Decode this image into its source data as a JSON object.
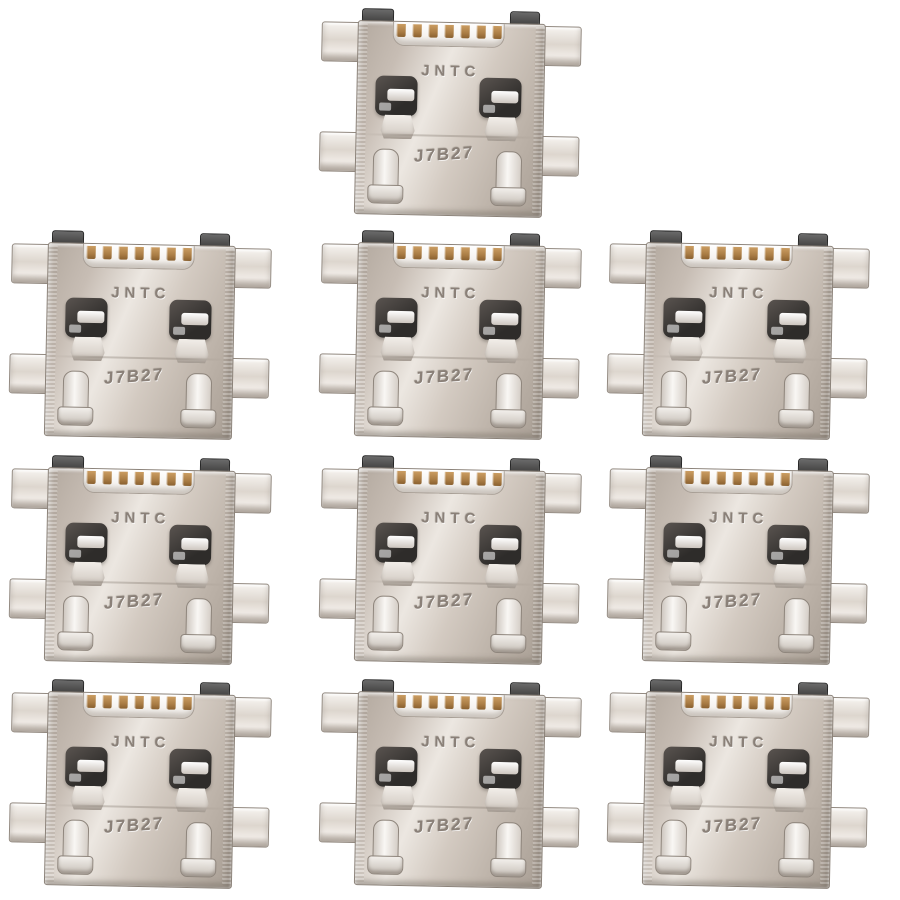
{
  "photo": {
    "background_color": "#ffffff",
    "item_count": 10
  },
  "connector": {
    "brand_marking": "JNTC",
    "code_marking": "J7B27",
    "pin_count": 7,
    "colors": {
      "bg": "#ffffff",
      "metal_base": "#c7bdb4",
      "metal_light": "#ece7e1",
      "metal_dark": "#a89e94",
      "metal_edge": "#8b8279",
      "latch": "#3e3c3a",
      "pin_gold": "#aa7d45",
      "tab": "#4a4846",
      "marking": "#8a8078"
    }
  },
  "layout": {
    "unit_width": 260,
    "unit_height": 206,
    "positions": [
      {
        "left": 320,
        "top": 10
      },
      {
        "left": 10,
        "top": 232
      },
      {
        "left": 320,
        "top": 232
      },
      {
        "left": 608,
        "top": 232
      },
      {
        "left": 10,
        "top": 457
      },
      {
        "left": 320,
        "top": 457
      },
      {
        "left": 608,
        "top": 457
      },
      {
        "left": 10,
        "top": 681
      },
      {
        "left": 320,
        "top": 681
      },
      {
        "left": 608,
        "top": 681
      }
    ]
  }
}
